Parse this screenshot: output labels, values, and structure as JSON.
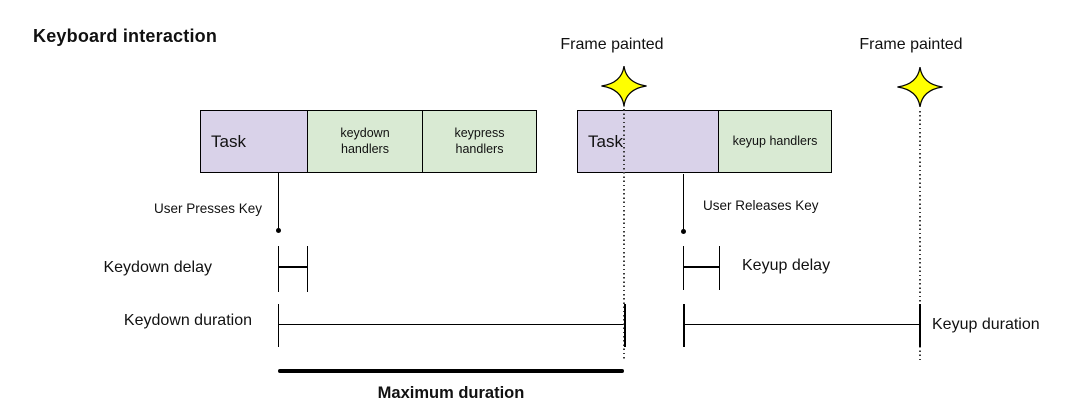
{
  "title": "Keyboard interaction",
  "frame_painted": {
    "first": "Frame painted",
    "second": "Frame painted"
  },
  "bars": {
    "group1": {
      "task_label": "Task",
      "segments": [
        "keydown handlers",
        "keypress handlers"
      ]
    },
    "group2": {
      "task_label": "Task",
      "segments": [
        "keyup handlers"
      ]
    }
  },
  "events": {
    "press_label": "User Presses Key",
    "release_label": "User Releases Key"
  },
  "measures": {
    "keydown_delay": "Keydown delay",
    "keydown_duration": "Keydown duration",
    "keyup_delay": "Keyup delay",
    "keyup_duration": "Keyup duration",
    "maximum_duration": "Maximum duration"
  },
  "icons": {
    "star": "frame-painted-star"
  },
  "colors": {
    "task_fill": "#d9d2e9",
    "handler_fill": "#d9ead3",
    "star_fill": "#ffff00",
    "line": "#000000",
    "background": "#ffffff"
  }
}
